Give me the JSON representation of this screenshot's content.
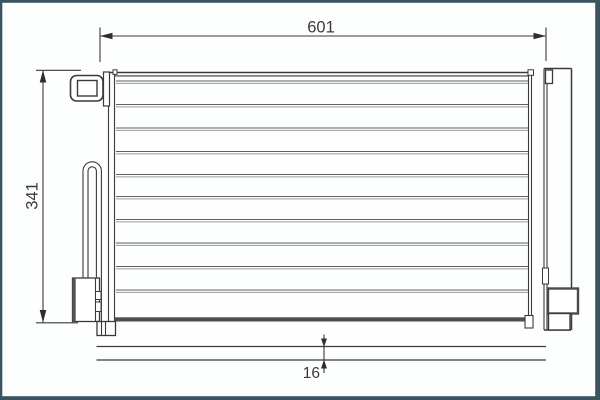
{
  "dimensions": {
    "overall_width": "601",
    "overall_height": "341",
    "core_depth": "16"
  },
  "colors": {
    "frame_border": "#3a5560",
    "line_dark": "#3a3a3a",
    "line_light": "#9a9a9a",
    "fill_dark": "#4f4f4f",
    "background": "#ffffff"
  }
}
